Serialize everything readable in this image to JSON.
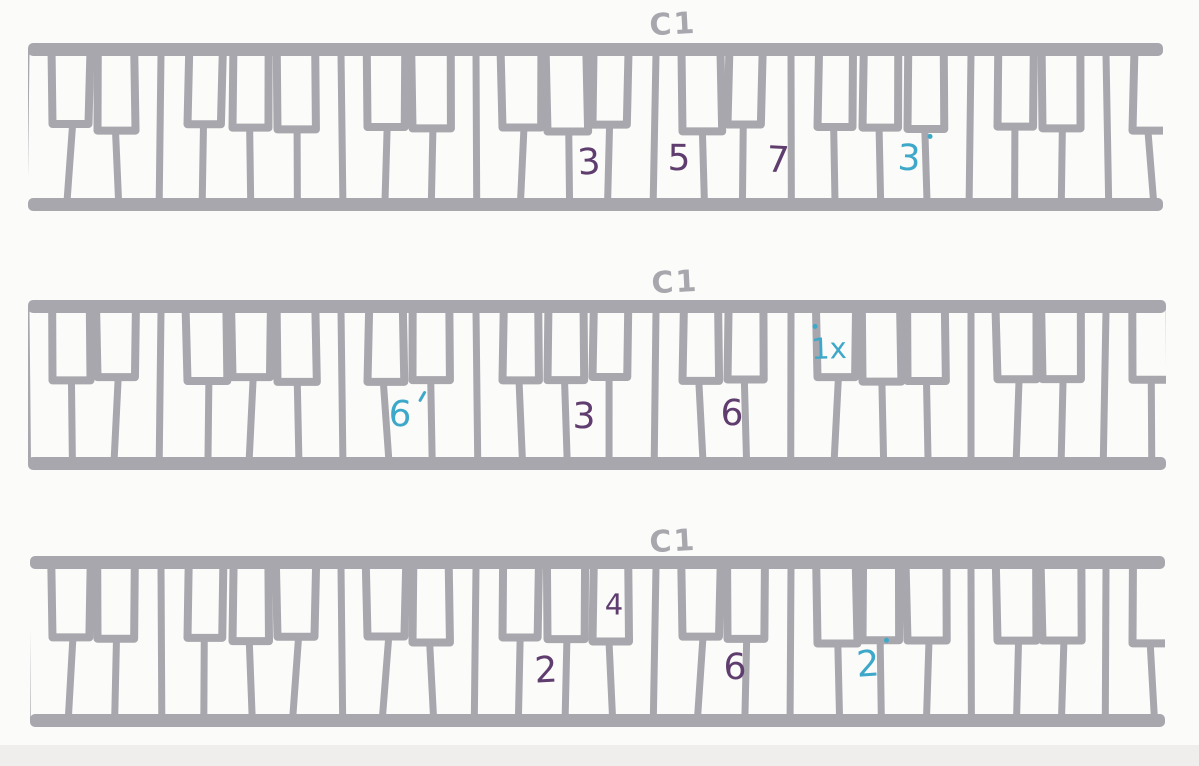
{
  "page": {
    "background": "#fbfbf9",
    "bottom_edge_color": "#efeeec"
  },
  "ink": {
    "marker_gray": "#a7a7ad",
    "pen_purple": "#5f3d6e",
    "pen_teal": "#3da8c9"
  },
  "keyboards": [
    {
      "octave_label": "C1",
      "label_pos": {
        "x": 673,
        "y": 25
      },
      "geometry": {
        "left": 28,
        "right": 1163,
        "top": 43,
        "bottom": 211,
        "rail_thickness": 13,
        "black_key_bottom": 128,
        "c_anchor_x": 656,
        "white_key_width": 45
      },
      "annotations": [
        {
          "text": "3",
          "color": "purple",
          "x": 589,
          "y": 163,
          "placement": "white-key"
        },
        {
          "text": "5",
          "color": "purple",
          "x": 679,
          "y": 159,
          "placement": "white-key"
        },
        {
          "text": "7",
          "color": "purple",
          "x": 778,
          "y": 161,
          "placement": "white-key"
        },
        {
          "text": "3",
          "color": "teal",
          "mark": "dot",
          "mark_pos": "right",
          "x": 909,
          "y": 159,
          "placement": "white-key"
        }
      ]
    },
    {
      "octave_label": "C1",
      "label_pos": {
        "x": 675,
        "y": 283
      },
      "geometry": {
        "left": 28,
        "right": 1166,
        "top": 300,
        "bottom": 470,
        "rail_thickness": 13,
        "black_key_bottom": 379,
        "c_anchor_x": 656,
        "white_key_width": 45
      },
      "annotations": [
        {
          "text": "6",
          "color": "teal",
          "mark": "tick",
          "mark_pos": "right",
          "x": 400,
          "y": 415,
          "placement": "white-key"
        },
        {
          "text": "3",
          "color": "purple",
          "x": 584,
          "y": 417,
          "placement": "white-key"
        },
        {
          "text": "6",
          "color": "purple",
          "x": 732,
          "y": 414,
          "placement": "white-key"
        },
        {
          "text": "1x",
          "color": "teal",
          "mark": "dot",
          "mark_pos": "left",
          "x": 829,
          "y": 349,
          "placement": "black-key"
        }
      ]
    },
    {
      "octave_label": "C1",
      "label_pos": {
        "x": 673,
        "y": 542
      },
      "geometry": {
        "left": 30,
        "right": 1165,
        "top": 556,
        "bottom": 727,
        "rail_thickness": 13,
        "black_key_bottom": 640,
        "c_anchor_x": 656,
        "white_key_width": 45
      },
      "annotations": [
        {
          "text": "4",
          "color": "purple",
          "x": 614,
          "y": 605,
          "placement": "black-key"
        },
        {
          "text": "2",
          "color": "purple",
          "x": 546,
          "y": 671,
          "placement": "white-key"
        },
        {
          "text": "6",
          "color": "purple",
          "x": 735,
          "y": 668,
          "placement": "white-key"
        },
        {
          "text": "2",
          "color": "teal",
          "mark": "dot",
          "mark_pos": "right",
          "x": 868,
          "y": 665,
          "placement": "white-key"
        }
      ]
    }
  ]
}
